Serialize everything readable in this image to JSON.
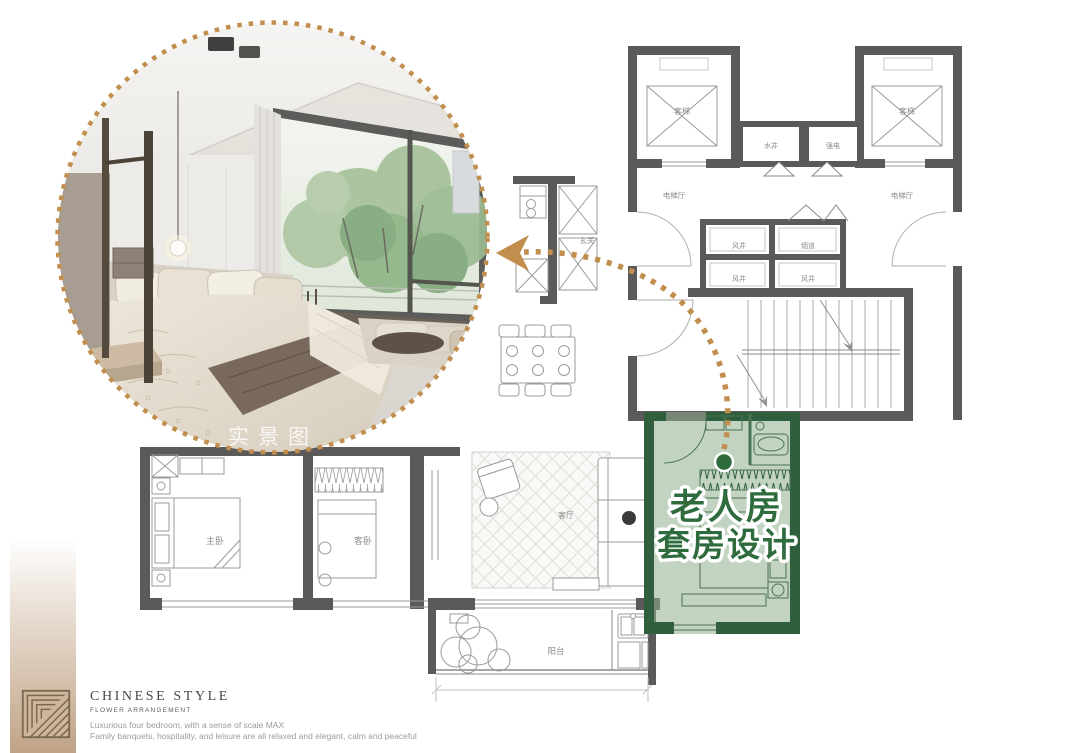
{
  "photo": {
    "watermark": "实景图"
  },
  "highlight": {
    "title_line1": "老人房",
    "title_line2": "套房设计",
    "text_color": "#2e6b3d",
    "area_color": "#8fae8e",
    "wall_color": "#2f5f3d"
  },
  "arrow": {
    "color": "#c28e4e"
  },
  "plan": {
    "labels": {
      "elevator_left": "客梯",
      "elevator_right": "客梯",
      "water_shaft": "水井",
      "strong_electric": "强电",
      "elevator_hall_left": "电梯厅",
      "elevator_hall_right": "电梯厅",
      "wind_shaft_top": "风井",
      "flue": "烟道",
      "wind_shaft_mid": "风井",
      "wind_shaft_right": "风井",
      "entrance": "玄关",
      "master_bedroom": "主卧",
      "guest_bedroom": "客卧",
      "living_room": "客厅",
      "balcony": "阳台"
    },
    "wall_color": "#5a5a5a",
    "line_color": "#9b9b9b"
  },
  "footer": {
    "brand_title": "CHINESE STYLE",
    "brand_subtitle": "FLOWER ARRANGEMENT",
    "desc_line1": "Luxurious four bedroom, with a sense of scale MAX",
    "desc_line2": "Family banquets, hospitality, and leisure are all relaxed and elegant, calm and peaceful"
  }
}
